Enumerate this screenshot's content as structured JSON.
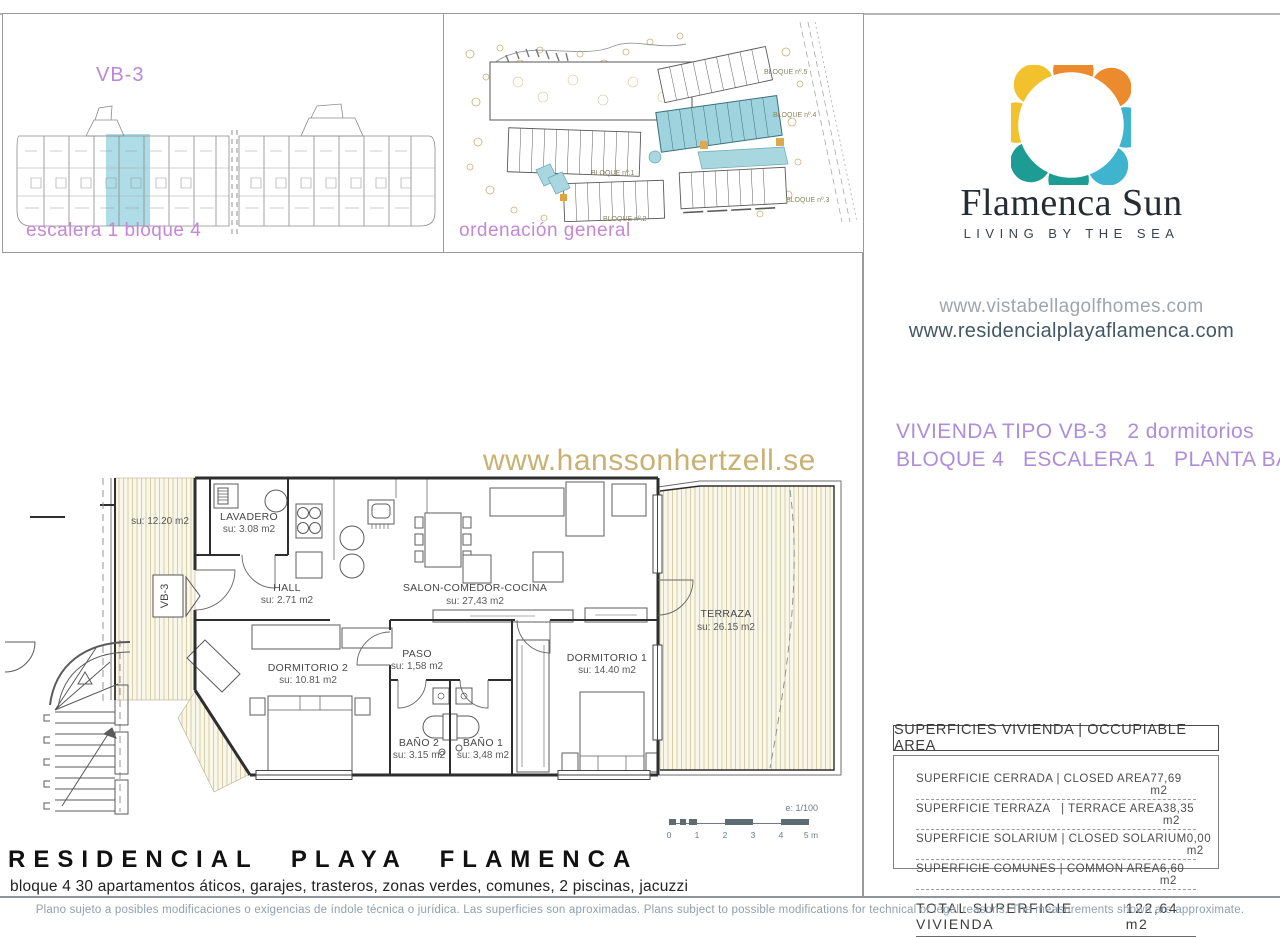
{
  "panel_elevation": {
    "tag": "VB-3",
    "caption": "escalera 1 bloque 4"
  },
  "panel_siteplan": {
    "caption": "ordenación general",
    "blocks": [
      "BLOQUE nº.5",
      "BLOQUE nº.4",
      "BLOQUE nº.3",
      "BLOQUE nº.2",
      "BLOQUE nº.1"
    ]
  },
  "brand": {
    "name": "Flamenca Sun",
    "tagline": "LIVING BY THE SEA",
    "website_1": "www.vistabellagolfhomes.com",
    "website_2": "www.residencialplayaflamenca.com",
    "logo_colors": {
      "orange": "#EC8B2D",
      "yellow": "#F2C12E",
      "teal": "#1C9C93",
      "cyan": "#3FB4CF"
    }
  },
  "unit": {
    "type_label": "VIVIENDA TIPO VB-3",
    "bedrooms": "2 dormitorios",
    "location": "BLOQUE 4   ESCALERA 1   PLANTA BAJA"
  },
  "watermark": "www.hanssonhertzell.se",
  "plan": {
    "tag": "VB-3",
    "rooms": {
      "terraza_izq": {
        "area": "su: 12.20 m2"
      },
      "lavadero": {
        "name": "LAVADERO",
        "area": "su: 3.08 m2"
      },
      "hall": {
        "name": "HALL",
        "area": "su: 2.71 m2"
      },
      "salon": {
        "name": "SALON-COMEDOR-COCINA",
        "area": "su: 27,43 m2"
      },
      "dormitorio2": {
        "name": "DORMITORIO 2",
        "area": "su: 10.81 m2"
      },
      "paso": {
        "name": "PASO",
        "area": "su: 1,58 m2"
      },
      "bano2": {
        "name": "BAÑO 2",
        "area": "su: 3.15 m2"
      },
      "bano1": {
        "name": "BAÑO 1",
        "area": "su: 3,48 m2"
      },
      "dormitorio1": {
        "name": "DORMITORIO 1",
        "area": "su: 14.40 m2"
      },
      "terraza": {
        "name": "TERRAZA",
        "area": "su: 26.15 m2"
      }
    },
    "scale": {
      "label": "e: 1/100",
      "ticks": [
        "0",
        "1",
        "2",
        "3",
        "4",
        "5 m"
      ]
    }
  },
  "surfaces": {
    "header": "SUPERFICIES VIVIENDA | OCCUPIABLE AREA",
    "rows": [
      {
        "label": "SUPERFICIE CERRADA | CLOSED AREA",
        "value": "77,69 m2"
      },
      {
        "label": "SUPERFICIE TERRAZA   | TERRACE AREA",
        "value": "38,35 m2"
      },
      {
        "label": "SUPERFICIE SOLARIUM | CLOSED SOLARIUM",
        "value": "0,00 m2"
      },
      {
        "label": "SUPERFICIE COMUNES | COMMON AREA",
        "value": "6,60 m2"
      }
    ],
    "total": {
      "label": "TOTAL SUPERFICIE VIVIENDA",
      "value": "122,64 m2"
    }
  },
  "footer": {
    "title": "RESIDENCIAL PLAYA FLAMENCA",
    "subtitle": "bloque 4 30 apartamentos áticos, garajes, trasteros, zonas verdes, comunes, 2 piscinas, jacuzzi",
    "disclaimer": "Plano sujeto a posibles modificaciones o exigencias de índole técnica o jurídica. Las superficies son aproximadas. Plans subject to possible modifications for technical or legal reasons. The measurements shown are approximate."
  }
}
